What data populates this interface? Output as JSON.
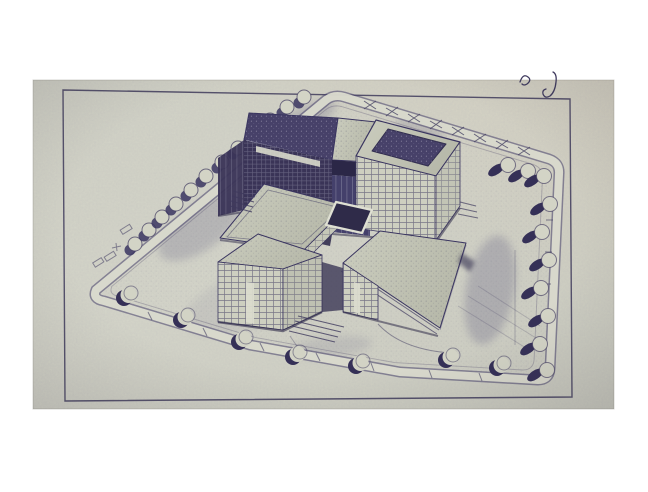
{
  "page": {
    "background_color": "#ffffff"
  },
  "photo": {
    "description": "Photograph of a page bearing a blueprint-ink aerial perspective drawing of a modernist building complex on a landscaped plot",
    "paper_color": "#d5d6c8",
    "ink_color": "#403b60"
  },
  "drawn_frame": {
    "label": "hand-ruled rectangular ink border around the drawing",
    "color": "#3e3a5a"
  },
  "handwriting": {
    "squiggle_label": "small handwritten pen squiggle above the border",
    "hook_label": "J-shaped pen stroke crossing the top border"
  },
  "scene": {
    "building": {
      "label": "complex of interlocking rectangular blocks with gridded curtain-wall facades and stippled flat roofs",
      "blocks": [
        {
          "label": "back-left tower with dark stippled roof"
        },
        {
          "label": "recessed centre link"
        },
        {
          "label": "back-right block with parapet tray roof"
        },
        {
          "label": "middle block"
        },
        {
          "label": "front-left gridded block"
        },
        {
          "label": "front-right low wing with wide flat roof"
        }
      ],
      "details": [
        "entrance steps",
        "courtyard enclosure walls",
        "doorway slits",
        "rooftop parapets",
        "ground shadow"
      ]
    },
    "site": {
      "label": "polygonal plot ringed by tree-lined perimeter roads",
      "roads": [
        {
          "label": "upper-left avenue",
          "trees": 12
        },
        {
          "label": "top road with cross-hatch paving",
          "trees": 2
        },
        {
          "label": "right road",
          "trees": 8
        },
        {
          "label": "bottom road",
          "trees": 7
        }
      ],
      "ground_marks": [
        "hedge rectangles",
        "survey cross",
        "sidewalk lines",
        "lawn shading smudges"
      ]
    }
  },
  "palette": {
    "white_background": "#ffffff",
    "paper": "#d5d6c8",
    "paper_shadow": "#c8cabb",
    "ink": "#403b60",
    "ink_dark": "#322e4f",
    "roof_dark": "#474169",
    "facade_dark": "#3a3457",
    "highlight": "#c9c9d8"
  }
}
